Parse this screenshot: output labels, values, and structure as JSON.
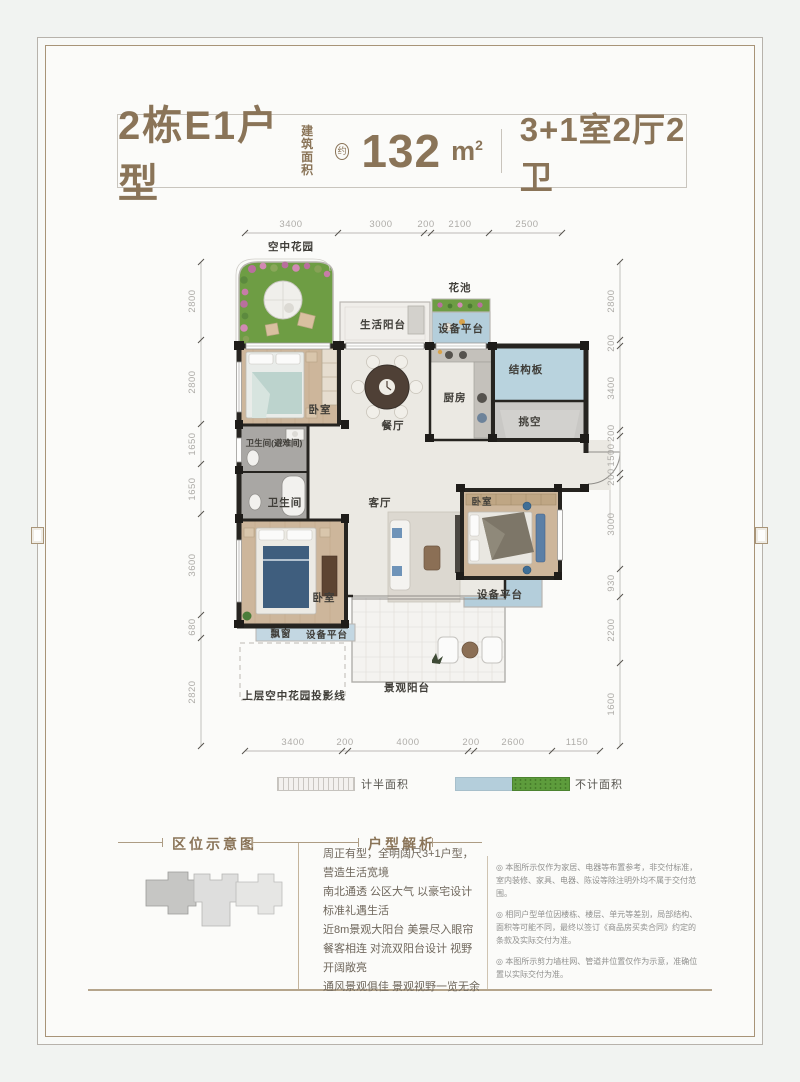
{
  "title": {
    "unit_name": "2栋E1户型",
    "area_label_line1": "建筑",
    "area_label_line2": "面积",
    "area_approx": "约",
    "area_value": "132",
    "area_unit": "m",
    "area_unit_sup": "2",
    "layout_spec": "3+1室2厅2卫"
  },
  "plan": {
    "labels": {
      "sky_garden": "空中花园",
      "flower_bed": "花池",
      "life_balcony": "生活阳台",
      "equip_top": "设备平台",
      "bedroom_top": "卧室",
      "bath_refuge": "卫生间(避难间)",
      "bathroom": "卫生间",
      "dining": "餐厅",
      "kitchen": "厨房",
      "structure_slab": "结构板",
      "void_space": "挑空",
      "living": "客厅",
      "bedroom_right": "卧室",
      "equip_right": "设备平台",
      "bedroom_master": "卧室",
      "bay_window": "飘窗",
      "equip_bottom": "设备平台",
      "projection_line": "上层空中花园投影线",
      "view_balcony": "景观阳台"
    },
    "dims": {
      "top": [
        "3400",
        "3000",
        "200",
        "2100",
        "2500"
      ],
      "bottom": [
        "3400",
        "200",
        "4000",
        "200",
        "2600",
        "1150"
      ],
      "left": [
        "2800",
        "2800",
        "1650",
        "1650",
        "3600",
        "680",
        "2820"
      ],
      "right": [
        "2800",
        "200",
        "3400",
        "200",
        "1500",
        "200",
        "3000",
        "930",
        "2200",
        "1600"
      ]
    }
  },
  "legend": {
    "half_area": "计半面积",
    "excluded_area": "不计面积"
  },
  "sections": {
    "location": {
      "heading": "区位示意图"
    },
    "analysis": {
      "heading": "户型解析",
      "lines": [
        "周正有型，全明阔尺3+1户型，营造生活宽境",
        "南北通透 公区大气 以豪宅设计标准礼遇生活",
        "近8m景观大阳台 美景尽入眼帘",
        "餐客相连 对流双阳台设计 视野开阔敞亮",
        "通风景观俱佳 景观视野一览无余"
      ]
    },
    "disclaimer": {
      "notes": [
        "◎ 本图所示仅作为家居、电器等布置参考，非交付标准，室内装修、家具、电器、陈设等除注明外均不属于交付范围。",
        "◎ 相同户型单位因楼栋、楼层、单元等差别，局部结构、面积等可能不同，最终以签订《商品房买卖合同》约定的条款及实际交付为准。",
        "◎ 本图所示剪力墙柱网、管道井位置仅作为示意，准确位置以实际交付为准。"
      ]
    }
  },
  "colors": {
    "accent_brown": "#8a7458",
    "platform_blue": "#b4cedb",
    "slab_blue": "#b9d3de",
    "garden_green": "#6e9d44",
    "legend_green": "#5d9c3c",
    "wall_dark": "#262420",
    "wood_floor": "#cbb296",
    "dim_text": "#adaba7"
  }
}
